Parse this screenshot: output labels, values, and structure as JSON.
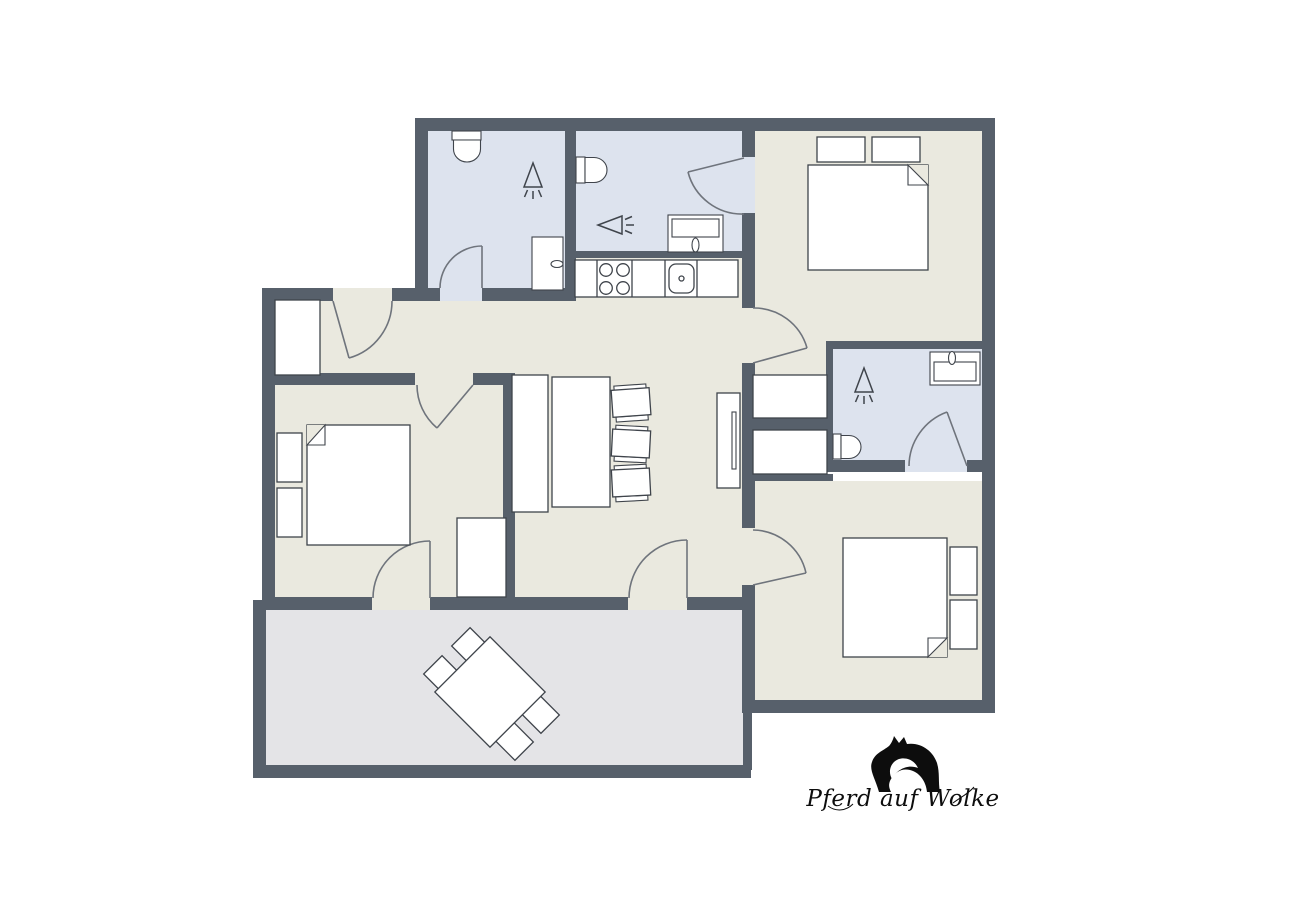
{
  "logo": {
    "text": "Pferd auf Wolke",
    "icon": "horse-head-icon"
  },
  "colors": {
    "wall": "#57606b",
    "bathroom_floor": "#dde3ee",
    "room_floor": "#eae9df",
    "terrace_floor": "#e4e4e7",
    "furniture_fill": "#ffffff",
    "furniture_line": "#3f444b",
    "door_line": "#6f747c",
    "background": "#ffffff",
    "logo_color": "#0d0d0d"
  },
  "plan": {
    "type": "apartment-floor-plan",
    "rooms": [
      {
        "name": "bathroom-top-left",
        "floor": "bathroom_floor",
        "items": [
          "toilet",
          "shower-head-icon",
          "tall-cabinet",
          "swing-door"
        ]
      },
      {
        "name": "bathroom-kitchen-side",
        "floor": "bathroom_floor",
        "items": [
          "toilet",
          "shower-head-icon",
          "washbasin",
          "swing-door"
        ]
      },
      {
        "name": "kitchenette-counter",
        "floor": "room_floor",
        "items": [
          "counter",
          "stove-4-burner",
          "kitchen-sink"
        ]
      },
      {
        "name": "bedroom-top-right",
        "floor": "room_floor",
        "items": [
          "double-bed",
          "pillows",
          "wardrobe",
          "wardrobe",
          "swing-door"
        ]
      },
      {
        "name": "bathroom-middle-right",
        "floor": "bathroom_floor",
        "items": [
          "toilet",
          "shower-head-icon",
          "washbasin",
          "swing-door"
        ]
      },
      {
        "name": "bedroom-bottom-right",
        "floor": "room_floor",
        "items": [
          "double-bed",
          "pillows",
          "swing-door"
        ]
      },
      {
        "name": "bedroom-left",
        "floor": "room_floor",
        "items": [
          "double-bed",
          "pillows",
          "wardrobe",
          "swing-door",
          "terrace-door"
        ]
      },
      {
        "name": "hallway-entrance",
        "floor": "room_floor",
        "items": [
          "entrance-door",
          "wardrobe"
        ]
      },
      {
        "name": "living-dining",
        "floor": "room_floor",
        "items": [
          "dining-table",
          "bench",
          "chair",
          "chair",
          "chair",
          "tv-sideboard",
          "terrace-door"
        ]
      },
      {
        "name": "terrace",
        "floor": "terrace_floor",
        "items": [
          "square-table-rotated",
          "chair",
          "chair",
          "chair",
          "chair"
        ]
      }
    ]
  }
}
